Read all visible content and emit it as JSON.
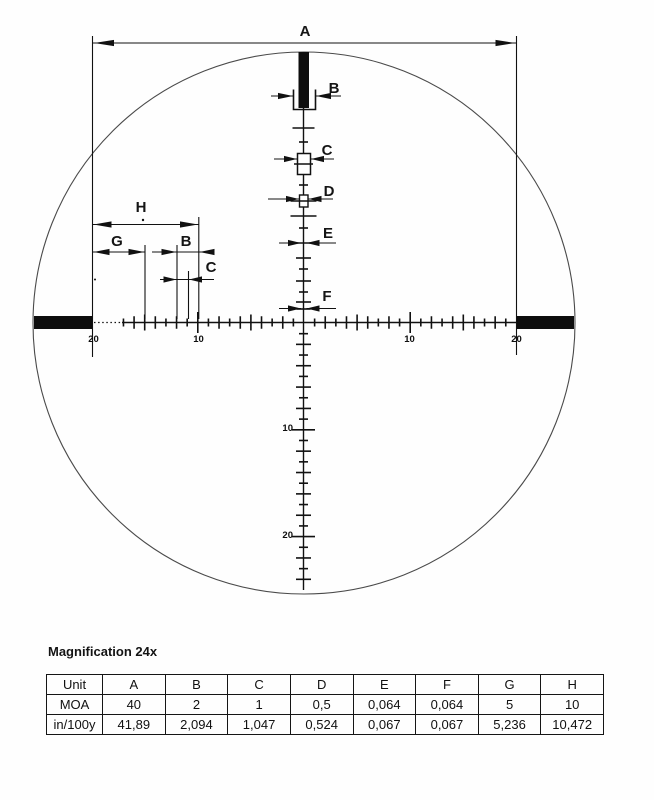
{
  "diagram": {
    "dimension_labels": {
      "A": "A",
      "B": "B",
      "C": "C",
      "D": "D",
      "E": "E",
      "F": "F",
      "G": "G",
      "H": "H"
    },
    "axis_labels": {
      "ten": "10",
      "twenty": "20"
    }
  },
  "caption": "Magnification 24x",
  "table": {
    "headers": [
      "Unit",
      "A",
      "B",
      "C",
      "D",
      "E",
      "F",
      "G",
      "H"
    ],
    "rows": [
      {
        "cells": [
          "MOA",
          "40",
          "2",
          "1",
          "0,5",
          "0,064",
          "0,064",
          "5",
          "10"
        ]
      },
      {
        "cells": [
          "in/100y",
          "41,89",
          "2,094",
          "1,047",
          "0,524",
          "0,067",
          "0,067",
          "5,236",
          "10,472"
        ]
      }
    ]
  }
}
